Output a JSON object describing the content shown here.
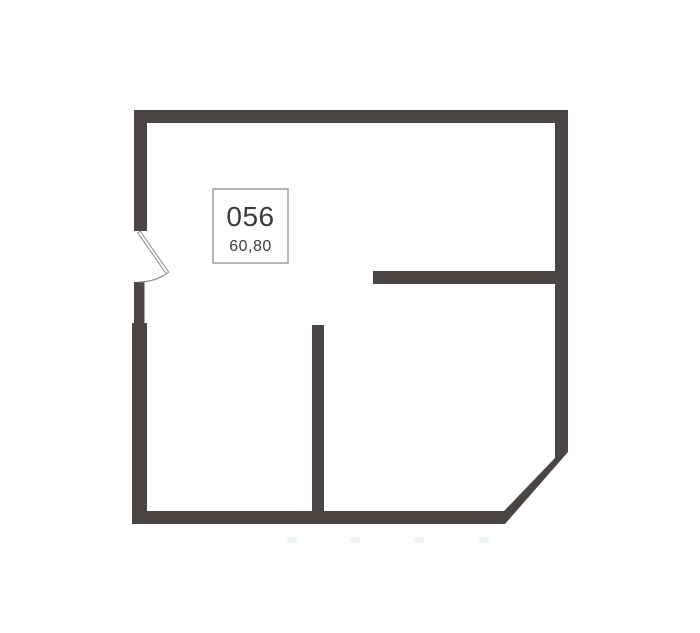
{
  "page": {
    "background": "#ffffff"
  },
  "floorplan": {
    "unit_number": "056",
    "area": "60,80",
    "colors": {
      "wall": "#4a4542",
      "label_text": "#3d3c3a",
      "label_border": "#8f8f8f",
      "label_fill": "#ffffff",
      "door_stroke": "#8c8c8c",
      "door_leaf_fill": "#ffffff",
      "artifact_dot": "#eef5f4",
      "background": "#ffffff"
    }
  }
}
